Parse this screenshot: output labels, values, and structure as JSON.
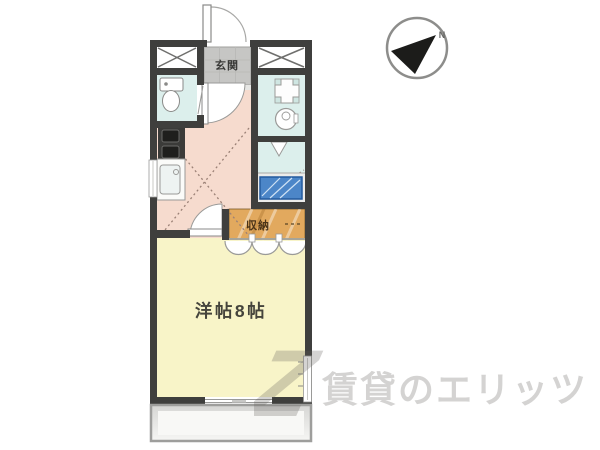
{
  "window": {
    "width": 600,
    "height": 450,
    "background": "#ffffff"
  },
  "floorplan": {
    "labels": {
      "entrance": "玄関",
      "storage": "収納",
      "main_room": "洋帖8帖"
    },
    "compass": {
      "north": "N"
    },
    "colors": {
      "wall": "#3f3f3d",
      "kitchen_hall": "#f6dbce",
      "main_room": "#f8f4c8",
      "wet_rooms": "#dcefec",
      "storage": "#e2a95e",
      "entrance_tile": "#c6c6c4",
      "laundry_pan_blue": "#4c86c8",
      "balcony": "#ececea"
    }
  },
  "watermark": {
    "logo": "Z",
    "text": "賃貸のエリッツ"
  }
}
